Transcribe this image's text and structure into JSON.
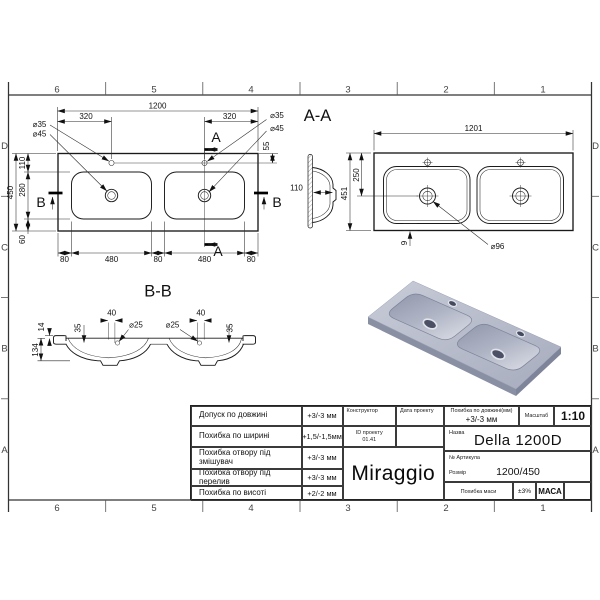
{
  "zones": {
    "cols": [
      "6",
      "5",
      "4",
      "3",
      "2",
      "1"
    ],
    "rows": [
      "D",
      "C",
      "B",
      "A"
    ]
  },
  "plan": {
    "dim_width": "1200",
    "dim_faucet_left": "320",
    "dim_faucet_right": "320",
    "faucet_dia_left": "⌀35",
    "drain_dia_left": "⌀45",
    "faucet_dia_right": "⌀35",
    "drain_dia_right": "⌀45",
    "dim_faucet_depth": "55",
    "dim_top_strip": "110",
    "dim_basin_height": "280",
    "dim_total_height": "450",
    "dim_bottom_strip": "60",
    "dims_bottom": [
      "80",
      "480",
      "80",
      "480",
      "80"
    ],
    "section_a": "A",
    "section_b": "B"
  },
  "section_aa": {
    "label": "A-A",
    "dim_depth": "110"
  },
  "bottom_view": {
    "dim_width": "1201",
    "dim_height": "451",
    "dim_drain_y": "250",
    "dim_edge": "9",
    "drain_dia": "⌀96"
  },
  "section_bb": {
    "label": "B-B",
    "dim_rim": "14",
    "dim_depth": "134",
    "dim_overflow_left": "35",
    "dim_hole_left": "40",
    "overflow_dia_left": "⌀25",
    "overflow_dia_right": "⌀25",
    "dim_hole_right": "40",
    "dim_overflow_right": "35"
  },
  "render": {
    "body_color": "#b6bac9",
    "shade_color": "#858ba0",
    "highlight_color": "#d8dbe4"
  },
  "titleblock": {
    "tolerances": [
      {
        "label": "Допуск по довжині",
        "value": "+3/-3 мм"
      },
      {
        "label": "Похибка по ширині",
        "value": "+1,5/-1,5мм"
      },
      {
        "label": "Похибка отвору під змішувач",
        "value": "+3/-3 мм"
      },
      {
        "label": "Похибка отвору під перелив",
        "value": "+3/-3 мм"
      },
      {
        "label": "Похибка по висоті",
        "value": "+2/-2 мм"
      }
    ],
    "constructor_label": "Конструктор",
    "date_label": "Дата проекту",
    "project_id_label": "ID проекту",
    "project_id_value": "01.41",
    "brand": "Miraggio",
    "length_tol_label": "Похибка по довжині(мм)",
    "length_tol_value": "+3/-3 мм",
    "scale_label": "Масштаб",
    "scale_value": "1:10",
    "name_label": "Назва",
    "name_value": "Della 1200D",
    "article_label": "№ Артикула",
    "size_label": "Розмір",
    "size_value": "1200/450",
    "mass_tol_label": "Похибка маси",
    "mass_tol_value": "±3%",
    "mass_label": "МАСА"
  }
}
